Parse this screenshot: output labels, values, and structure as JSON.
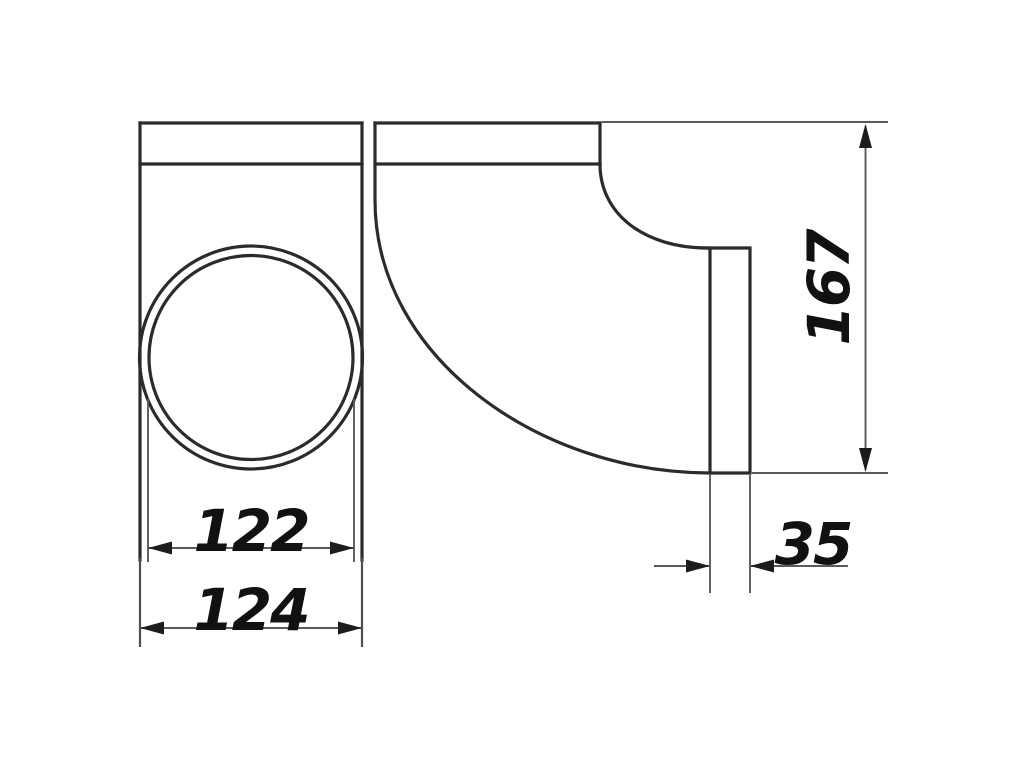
{
  "drawing": {
    "dimensions": {
      "inner_diameter": "122",
      "outer_width": "124",
      "overall_height": "167",
      "socket_depth": "35"
    },
    "colors": {
      "background": "#ffffff",
      "outline": "#2b2b2b",
      "dimension_lines": "#5a5a5a",
      "arrowheads": "#1c1c1c",
      "dimension_text": "#111111"
    }
  }
}
